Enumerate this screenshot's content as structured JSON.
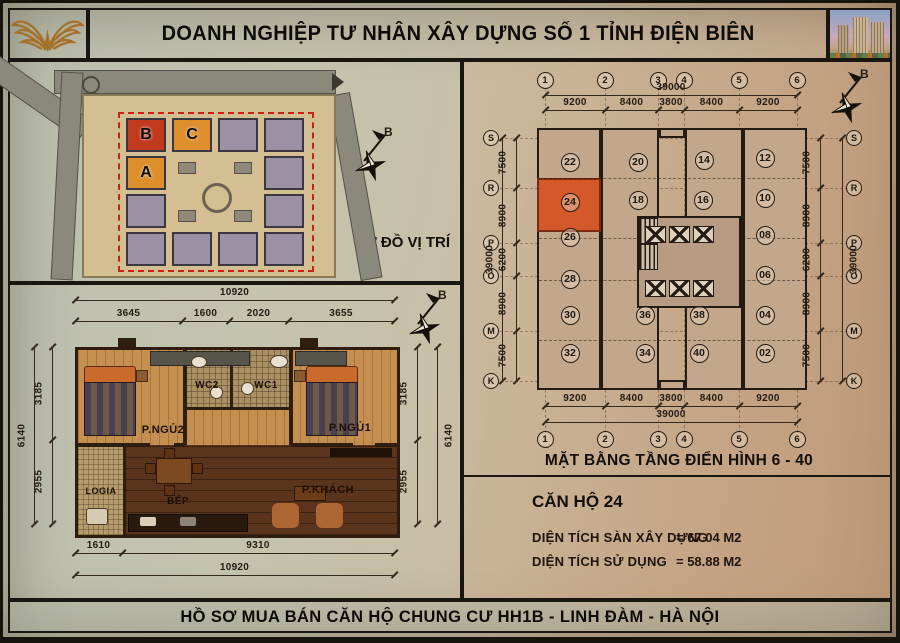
{
  "header": {
    "title": "DOANH NGHIỆP TƯ NHÂN XÂY DỰNG SỐ 1 TỈNH ĐIỆN BIÊN",
    "logo_icon": "gold-wings-emblem",
    "photo": "apartment-building-rendering"
  },
  "site_plan": {
    "caption": "SƠ ĐỒ VỊ TRÍ",
    "street_top": "ĐƯỜNG VÀO BÁN ĐẢO LINH ĐÀM",
    "street_left": "ĐƯỜNG NGUYỄN HỮU THỌ",
    "compass_label": "B",
    "blocks": [
      {
        "label": "B",
        "color": "#c23a1e"
      },
      {
        "label": "C",
        "color": "#dd8f2b"
      },
      {
        "label": "A",
        "color": "#dd8f2b"
      }
    ],
    "boundary_color": "#cf1f10"
  },
  "apartment_plan": {
    "compass_label": "B",
    "rooms": {
      "bedroom2": "P.NGỦ2",
      "wc2": "WC2",
      "wc1": "WC1",
      "bedroom1": "P.NGỦ1",
      "loggia": "LOGIA",
      "kitchen": "BẾP",
      "living": "P.KHÁCH"
    },
    "dims": {
      "top_total": "10920",
      "top": [
        "3645",
        "1600",
        "2020",
        "3655"
      ],
      "bottom": [
        "1610",
        "9310"
      ],
      "bottom_total": "10920",
      "left": [
        "3185",
        "2955"
      ],
      "right": [
        "3185",
        "2955"
      ],
      "side_total": "6140"
    }
  },
  "floor_plan": {
    "caption": "MẶT BẰNG TẦNG ĐIỂN HÌNH 6 - 40",
    "compass_label": "B",
    "grid_cols": [
      "1",
      "2",
      "3",
      "4",
      "5",
      "6"
    ],
    "grid_rows": [
      "S",
      "R",
      "P",
      "O",
      "M",
      "K"
    ],
    "dims_h": [
      "9200",
      "8400",
      "3800",
      "8400",
      "9200"
    ],
    "dims_h_total": "39000",
    "dims_v": [
      "7500",
      "8900",
      "6200",
      "8900",
      "7500"
    ],
    "dims_v_total": "39000",
    "units": {
      "left_wing": [
        "22",
        "24",
        "26",
        "28",
        "30",
        "32"
      ],
      "center_left": [
        "20",
        "18",
        "36",
        "34"
      ],
      "center_right": [
        "14",
        "16",
        "38",
        "40"
      ],
      "right_wing": [
        "12",
        "10",
        "08",
        "06",
        "04",
        "02"
      ]
    },
    "highlight_unit": "24",
    "highlight_color": "#d4582a"
  },
  "unit_info": {
    "title": "CĂN HỘ 24",
    "rows": [
      {
        "label": "DIỆN TÍCH SÀN XÂY DỰNG",
        "value": "= 67.04 M2"
      },
      {
        "label": "DIỆN TÍCH SỬ DỤNG",
        "value": "= 58.88 M2"
      }
    ]
  },
  "footer": {
    "title": "HỒ SƠ MUA BÁN CĂN HỘ CHUNG CƯ HH1B - LINH ĐÀM - HÀ NỘI"
  }
}
